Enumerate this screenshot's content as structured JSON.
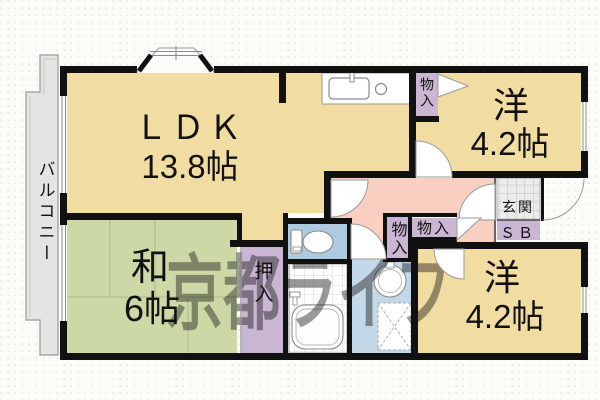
{
  "watermark": {
    "text": "京都ライフ"
  },
  "colors": {
    "room": "#f1dda2",
    "tatami": "#cdd8a7",
    "hall": "#f8cfc0",
    "toilet_room": "#aecadf",
    "washroom": "#c3d9ea",
    "closet": "#cab5d2",
    "balcony": "#e4e4e3",
    "wall": "#111111",
    "genkan_tile": "#ececec",
    "watermark_color": "#7d7482",
    "fixture_stroke": "#8a8a8a"
  },
  "rooms": {
    "ldk": {
      "label": "ＬＤＫ",
      "size": "13.8帖"
    },
    "japanese_room": {
      "label": "和",
      "size": "6帖"
    },
    "western_room_top": {
      "label": "洋",
      "size": "4.2帖"
    },
    "western_room_bottom": {
      "label": "洋",
      "size": "4.2帖"
    },
    "balcony": {
      "label": "バルコニー"
    },
    "entrance": {
      "label": "玄関"
    },
    "shoe_box": {
      "label": "ＳＢ"
    }
  },
  "closets": {
    "oshiire": {
      "label": "押入"
    },
    "monoire_top": {
      "label": "物入"
    },
    "monoire_mid": {
      "label": "物入"
    },
    "monoire_side": {
      "label": "物入"
    }
  }
}
